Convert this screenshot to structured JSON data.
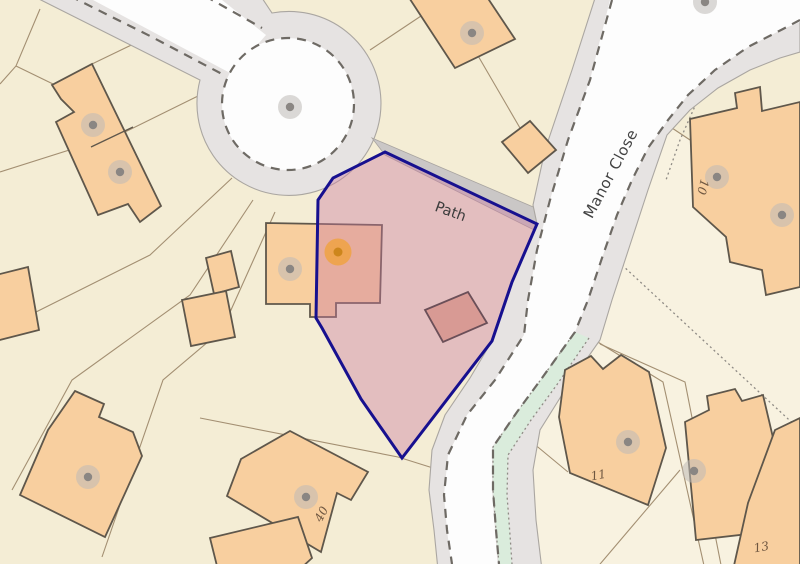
{
  "map": {
    "road_labels": {
      "path": {
        "text": "Path",
        "transform": "translate(449,216) rotate(20)"
      },
      "manor_close": {
        "text": "Manor Close",
        "transform": "translate(615,176) rotate(-62)"
      }
    },
    "house_numbers": [
      {
        "text": "10",
        "transform": "translate(699,186) rotate(105)"
      },
      {
        "text": "11",
        "transform": "translate(599,479) rotate(-10)"
      },
      {
        "text": "13",
        "transform": "translate(762,551) rotate(-10)"
      },
      {
        "text": "40",
        "transform": "translate(325,516) rotate(-62)"
      }
    ],
    "markers": [
      {
        "type": "gray",
        "transform": "translate(290,107)"
      },
      {
        "type": "gray",
        "transform": "translate(93,125)"
      },
      {
        "type": "gray",
        "transform": "translate(120,172)"
      },
      {
        "type": "gray",
        "transform": "translate(472,33)"
      },
      {
        "type": "gray",
        "transform": "translate(290,269)"
      },
      {
        "type": "orange",
        "transform": "translate(338,252)"
      },
      {
        "type": "gray",
        "transform": "translate(717,177)"
      },
      {
        "type": "gray",
        "transform": "translate(782,215)"
      },
      {
        "type": "gray",
        "transform": "translate(628,442)"
      },
      {
        "type": "gray",
        "transform": "translate(306,497)"
      },
      {
        "type": "gray",
        "transform": "translate(88,477)"
      },
      {
        "type": "gray",
        "transform": "translate(694,471)"
      },
      {
        "type": "gray",
        "transform": "translate(705,2)"
      }
    ],
    "colors": {
      "background": "#f4edd5",
      "light_parcel": "#f8f2e0",
      "building_fill": "#f8cf9f",
      "building_stroke": "#5f574b",
      "road_surface": "#fdfdfd",
      "road_shoulder": "#e6e3e2",
      "path_strip": "#cac7c6",
      "verge_green": "#daecdc",
      "plot_outline": "#17108f",
      "plot_fill": "#cb789e",
      "marker_gray": "#8a8683",
      "marker_orange": "#cd861c"
    }
  }
}
